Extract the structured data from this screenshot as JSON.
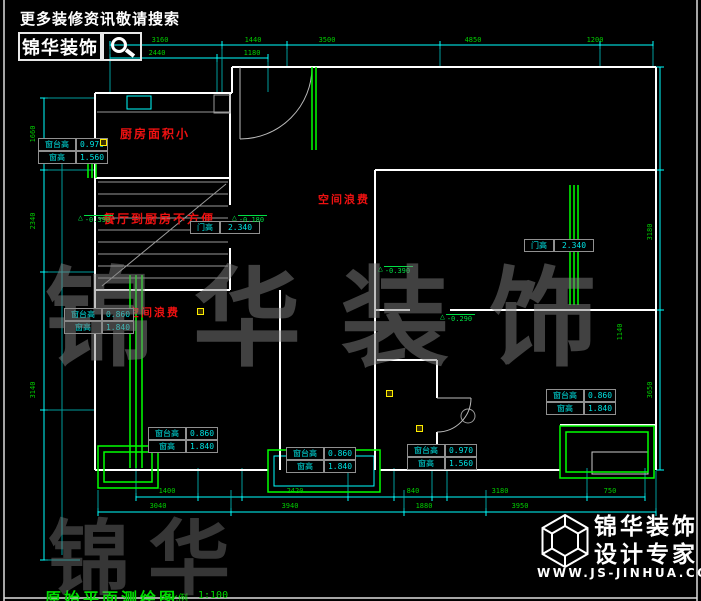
{
  "header": {
    "tagline": "更多装修资讯敬请搜索",
    "brand": "锦华装饰"
  },
  "footer": {
    "brand": "锦华装饰",
    "tagline": "设计专家",
    "website": "WWW.JS-JINHUA.COM"
  },
  "title_block": {
    "drawing_name": "原始平面测绘图",
    "scale_label": "比例",
    "scale_value": "1:100"
  },
  "watermark": {
    "main_chars": "锦华装饰",
    "partial_chars": "锦华"
  },
  "colors": {
    "dim_line": "#00ffff",
    "dim_text": "#00cc00",
    "window_line": "#00ff00",
    "wall_line": "#ffffff",
    "annotation_red": "#ee1111",
    "table_text": "#00e5e5",
    "marker_yellow": "#ffee00"
  },
  "annotations_red": [
    {
      "text": "厨房面积小",
      "x": 120,
      "y": 125,
      "size": 12
    },
    {
      "text": "餐厅到厨房不方便",
      "x": 103,
      "y": 210,
      "size": 12
    },
    {
      "text": "空间浪费",
      "x": 318,
      "y": 191,
      "size": 11
    },
    {
      "text": "空间浪费",
      "x": 128,
      "y": 304,
      "size": 11
    }
  ],
  "elevation_markers": [
    {
      "value": "-0.390",
      "x": 78,
      "y": 213
    },
    {
      "value": "-0.180",
      "x": 232,
      "y": 213
    },
    {
      "value": "-0.390",
      "x": 378,
      "y": 264
    },
    {
      "value": "-0.290",
      "x": 440,
      "y": 312
    }
  ],
  "window_tables": [
    {
      "x": 38,
      "y": 138,
      "rows": [
        [
          "窗台高",
          "0.970"
        ],
        [
          "窗高",
          "1.560"
        ]
      ]
    },
    {
      "x": 64,
      "y": 308,
      "rows": [
        [
          "窗台高",
          "0.860"
        ],
        [
          "窗高",
          "1.840"
        ]
      ]
    },
    {
      "x": 148,
      "y": 427,
      "rows": [
        [
          "窗台高",
          "0.860"
        ],
        [
          "窗高",
          "1.840"
        ]
      ]
    },
    {
      "x": 286,
      "y": 447,
      "rows": [
        [
          "窗台高",
          "0.860"
        ],
        [
          "窗高",
          "1.840"
        ]
      ]
    },
    {
      "x": 407,
      "y": 444,
      "rows": [
        [
          "窗台高",
          "0.970"
        ],
        [
          "窗高",
          "1.560"
        ]
      ]
    },
    {
      "x": 546,
      "y": 389,
      "rows": [
        [
          "窗台高",
          "0.860"
        ],
        [
          "窗高",
          "1.840"
        ]
      ]
    }
  ],
  "door_tables": [
    {
      "x": 190,
      "y": 221,
      "label": "门高",
      "value": "2.340"
    },
    {
      "x": 524,
      "y": 239,
      "label": "门高",
      "value": "2.340"
    }
  ],
  "dimensions": [
    {
      "text": "3160",
      "x": 160,
      "y": 40
    },
    {
      "text": "1440",
      "x": 253,
      "y": 40
    },
    {
      "text": "3500",
      "x": 327,
      "y": 40
    },
    {
      "text": "4850",
      "x": 473,
      "y": 40
    },
    {
      "text": "1200",
      "x": 595,
      "y": 40
    },
    {
      "text": "2440",
      "x": 157,
      "y": 53
    },
    {
      "text": "1180",
      "x": 252,
      "y": 53
    },
    {
      "text": "1400",
      "x": 167,
      "y": 491
    },
    {
      "text": "2420",
      "x": 295,
      "y": 491
    },
    {
      "text": "840",
      "x": 413,
      "y": 491
    },
    {
      "text": "3180",
      "x": 500,
      "y": 491
    },
    {
      "text": "750",
      "x": 610,
      "y": 491
    },
    {
      "text": "3040",
      "x": 158,
      "y": 506
    },
    {
      "text": "3940",
      "x": 290,
      "y": 506
    },
    {
      "text": "1880",
      "x": 424,
      "y": 506
    },
    {
      "text": "3950",
      "x": 520,
      "y": 506
    },
    {
      "text": "1660",
      "x": 33,
      "y": 134,
      "rot": true
    },
    {
      "text": "2340",
      "x": 33,
      "y": 221,
      "rot": true
    },
    {
      "text": "3140",
      "x": 33,
      "y": 390,
      "rot": true
    },
    {
      "text": "3180",
      "x": 650,
      "y": 232,
      "rot": true
    },
    {
      "text": "3650",
      "x": 650,
      "y": 390,
      "rot": true
    },
    {
      "text": "1140",
      "x": 620,
      "y": 332,
      "rot": true
    }
  ],
  "markers_yellow": [
    {
      "x": 100,
      "y": 139
    },
    {
      "x": 197,
      "y": 308
    },
    {
      "x": 386,
      "y": 390
    },
    {
      "x": 416,
      "y": 425
    }
  ]
}
